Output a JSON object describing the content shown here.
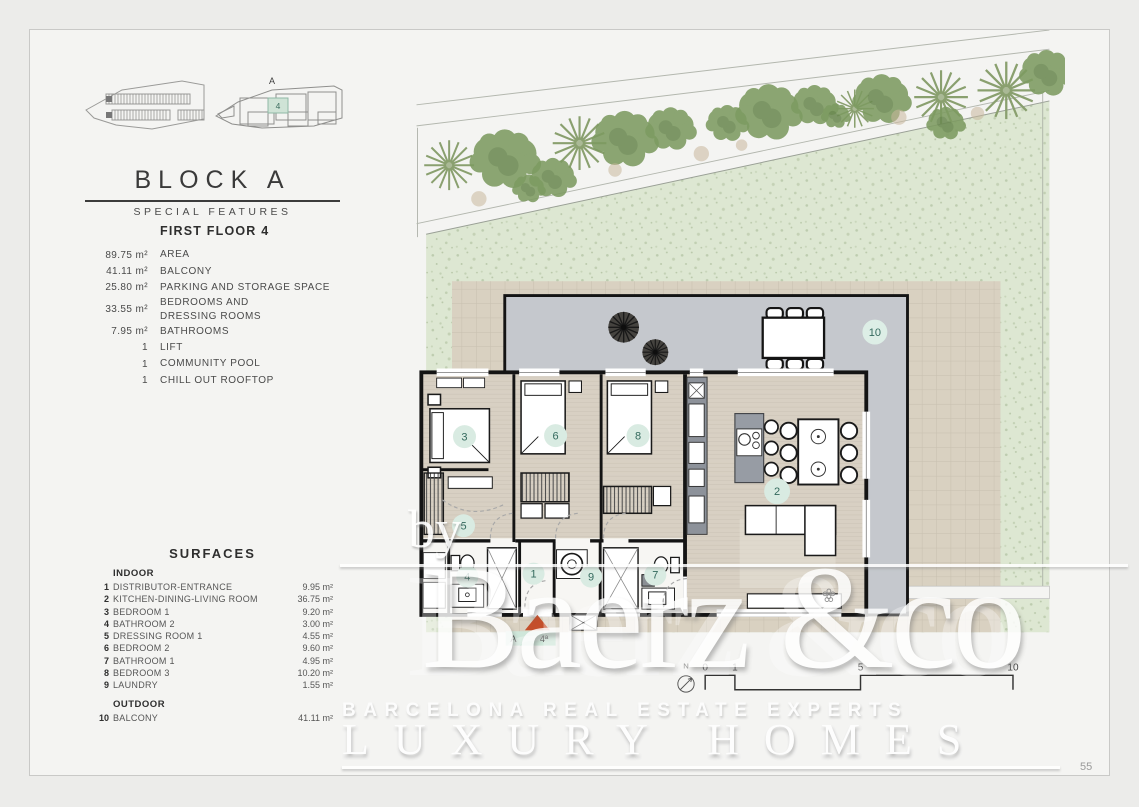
{
  "page": {
    "number": "55"
  },
  "header": {
    "block_title": "BLOCK A",
    "subtitle": "SPECIAL FEATURES"
  },
  "minimap": {
    "block_label": "A",
    "unit": "4"
  },
  "features": {
    "title": "FIRST FLOOR 4",
    "rows": [
      {
        "value": "89.75 m²",
        "label": "AREA"
      },
      {
        "value": "41.11 m²",
        "label": "BALCONY"
      },
      {
        "value": "25.80 m²",
        "label": "PARKING AND STORAGE SPACE"
      },
      {
        "value": "33.55 m²",
        "label": "BEDROOMS AND\nDRESSING ROOMS"
      },
      {
        "value": "7.95 m²",
        "label": "BATHROOMS"
      },
      {
        "value": "1",
        "label": "LIFT"
      },
      {
        "value": "1",
        "label": "COMMUNITY POOL"
      },
      {
        "value": "1",
        "label": "CHILL OUT ROOFTOP"
      }
    ]
  },
  "surfaces": {
    "title": "SURFACES",
    "indoor_heading": "INDOOR",
    "indoor": [
      {
        "num": "1",
        "name": "DISTRIBUTOR-ENTRANCE",
        "area": "9.95 m²"
      },
      {
        "num": "2",
        "name": "KITCHEN-DINING-LIVING ROOM",
        "area": "36.75 m²"
      },
      {
        "num": "3",
        "name": "BEDROOM 1",
        "area": "9.20 m²"
      },
      {
        "num": "4",
        "name": "BATHROOM 2",
        "area": "3.00 m²"
      },
      {
        "num": "5",
        "name": "DRESSING ROOM 1",
        "area": "4.55 m²"
      },
      {
        "num": "6",
        "name": "BEDROOM 2",
        "area": "9.60 m²"
      },
      {
        "num": "7",
        "name": "BATHROOM 1",
        "area": "4.95 m²"
      },
      {
        "num": "8",
        "name": "BEDROOM 3",
        "area": "10.20 m²"
      },
      {
        "num": "9",
        "name": "LAUNDRY",
        "area": "1.55 m²"
      }
    ],
    "outdoor_heading": "OUTDOOR",
    "outdoor": [
      {
        "num": "10",
        "name": "BALCONY",
        "area": "41.11 m²"
      }
    ]
  },
  "plan": {
    "badges": {
      "b1": "1",
      "b2": "2",
      "b3": "3",
      "b4": "4",
      "b5": "5",
      "b6": "6",
      "b7": "7",
      "b8": "8",
      "b9": "9",
      "b10": "10"
    },
    "entrance": {
      "left": "A",
      "right": "4ª"
    },
    "scale": {
      "north": "N",
      "ticks": [
        "0",
        "1",
        "5",
        "10"
      ]
    }
  },
  "watermark": {
    "by": "by",
    "brand": "Baerz &co",
    "line1": "BARCELONA REAL ESTATE EXPERTS",
    "line2": "LUXURY HOMES"
  },
  "colors": {
    "badge_bg": "#d9ebe2",
    "badge_text": "#33695d",
    "arrow_red": "#c44f2b",
    "garden_green": "#dde7d2",
    "terrace_tan": "#d9d1c1",
    "balcony_gray": "#c5c8cd",
    "highlight_cell": "#cfe3d6"
  }
}
